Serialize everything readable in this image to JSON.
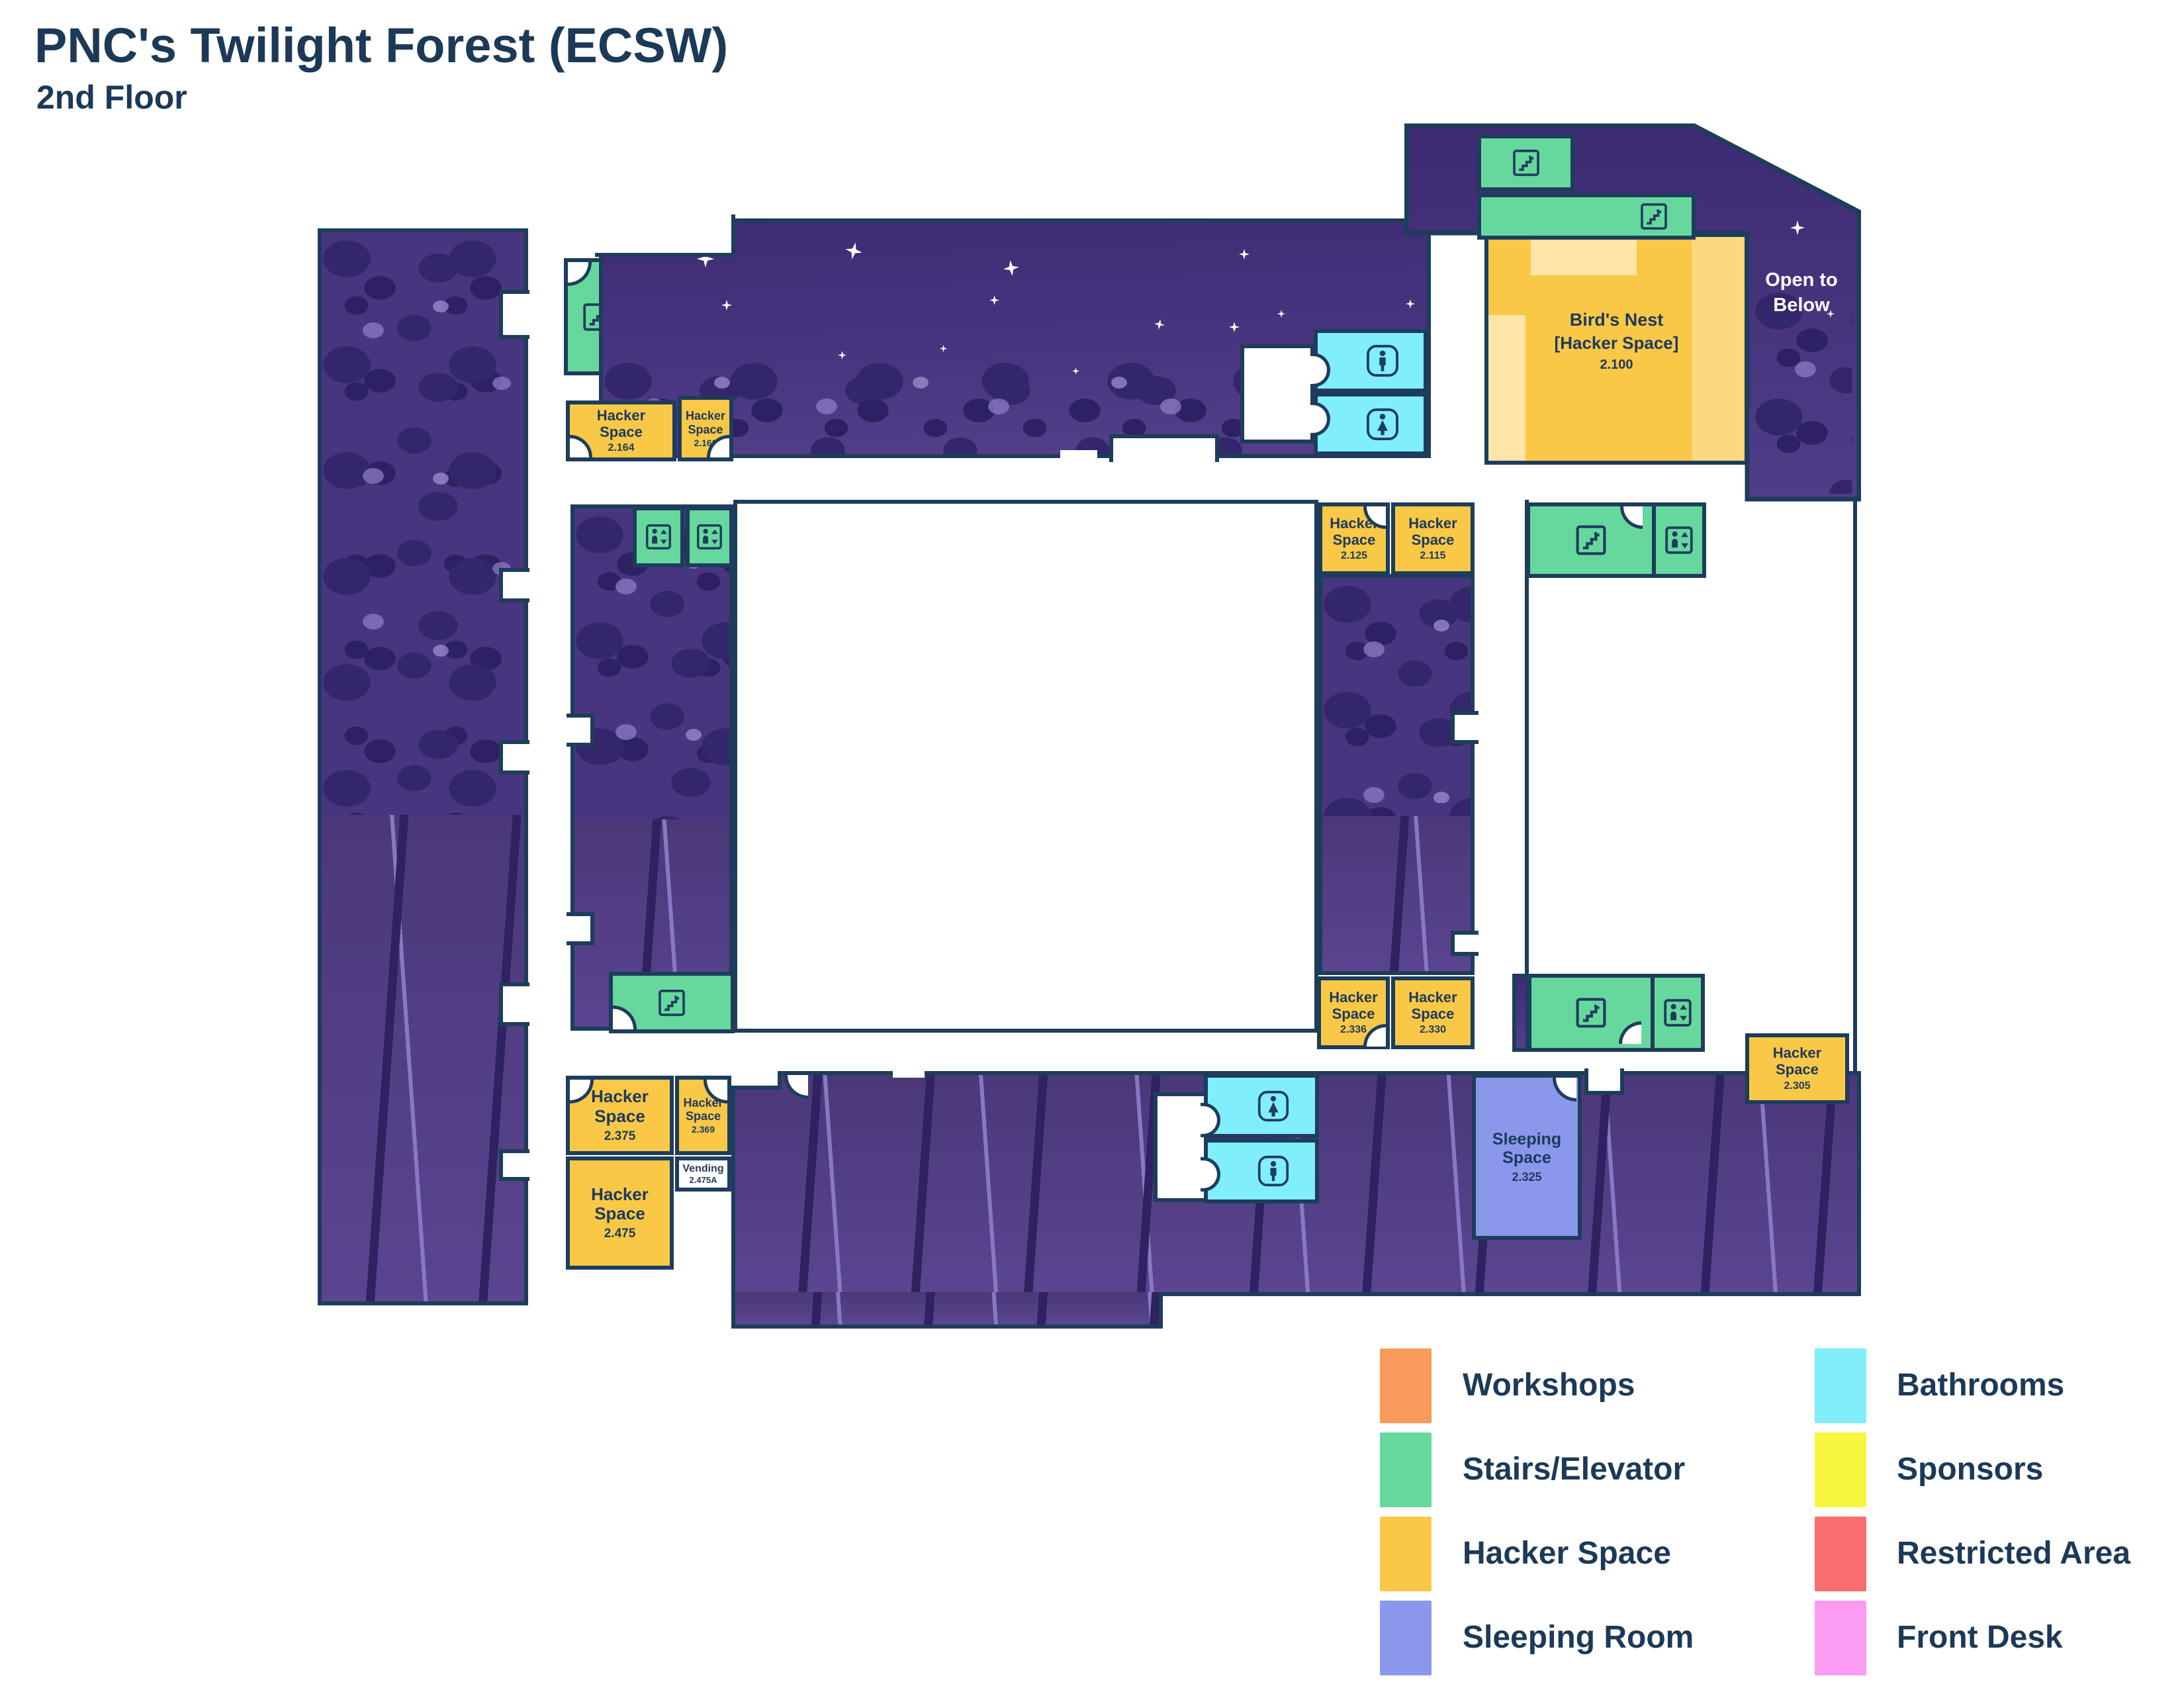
{
  "title": "PNC's Twilight Forest (ECSW)",
  "subtitle": "2nd Floor",
  "map": {
    "open_to_below": "Open to Below",
    "rooms": {
      "birds_nest": {
        "name": "Bird's Nest",
        "tag": "[Hacker Space]",
        "number": "2.100"
      },
      "h2164": {
        "name": "Hacker Space",
        "number": "2.164"
      },
      "h2160": {
        "name": "Hacker Space",
        "number": "2.160"
      },
      "h2125": {
        "name": "Hacker Space",
        "number": "2.125"
      },
      "h2115": {
        "name": "Hacker Space",
        "number": "2.115"
      },
      "h2336": {
        "name": "Hacker Space",
        "number": "2.336"
      },
      "h2330": {
        "name": "Hacker Space",
        "number": "2.330"
      },
      "h2375": {
        "name": "Hacker Space",
        "number": "2.375"
      },
      "h2369": {
        "name": "Hacker Space",
        "number": "2.369"
      },
      "h2475": {
        "name": "Hacker Space",
        "number": "2.475"
      },
      "h2305": {
        "name": "Hacker Space",
        "number": "2.305"
      },
      "vending": {
        "name": "Vending",
        "number": "2.475A"
      },
      "sleeping": {
        "name": "Sleeping Space",
        "number": "2.325"
      }
    }
  },
  "legend": {
    "left": [
      {
        "label": "Workshops",
        "color": "#F89B5A"
      },
      {
        "label": "Stairs/Elevator",
        "color": "#66D89E"
      },
      {
        "label": "Hacker Space",
        "color": "#F9C847"
      },
      {
        "label": "Sleeping Room",
        "color": "#8B97EB"
      }
    ],
    "right": [
      {
        "label": "Bathrooms",
        "color": "#80EEFB"
      },
      {
        "label": "Sponsors",
        "color": "#F6F63F"
      },
      {
        "label": "Restricted Area",
        "color": "#F96F6F"
      },
      {
        "label": "Front Desk",
        "color": "#FA9DF2"
      }
    ]
  },
  "icons": {
    "stairs": "stairs-icon",
    "elevator": "elevator-icon",
    "male": "man-icon",
    "female": "woman-icon"
  },
  "colors": {
    "wall": "#1E3D5C",
    "text": "#1D3A5C",
    "hacker_space": "#F9C847",
    "stairs_elevator": "#66D89E",
    "bathroom": "#80EEFB",
    "sleeping_room": "#8B97EB",
    "night_purple": "#43307C",
    "forest_purple": "#4A3879"
  }
}
